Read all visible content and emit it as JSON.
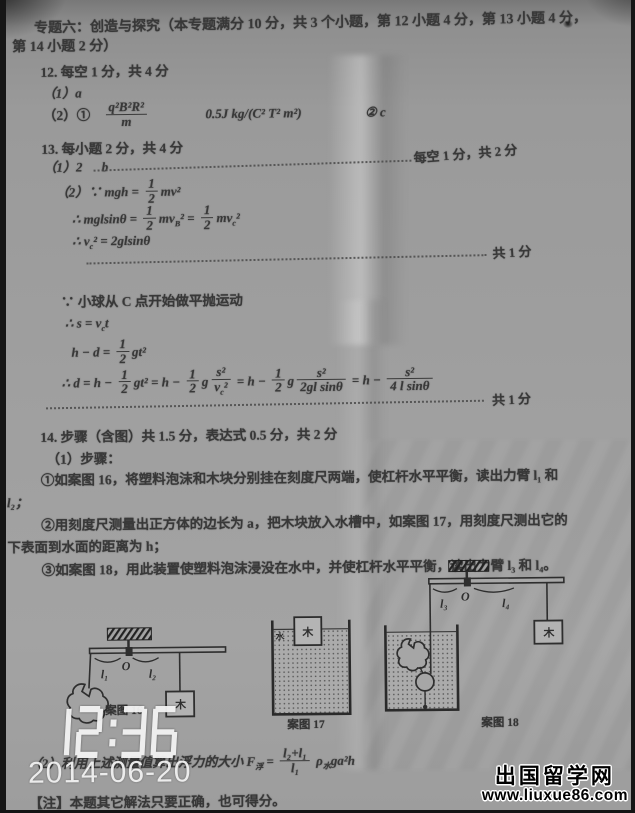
{
  "overlay": {
    "time": "12:36",
    "date": "2014-06-20"
  },
  "watermark": {
    "site_name": "出国留学网",
    "url_prefix": "www.liuxue",
    "url_num": "86",
    "url_suffix": ".com",
    "red": "#c3261c",
    "blue": "#1e3e9e"
  },
  "header": {
    "line1": "专题六：创造与探究（本专题满分 10 分，共 3 个小题，第 12 小题 4 分，第 13 小题 4 分，",
    "line2": "第 14 小题 2 分）"
  },
  "q12": {
    "title": "12. 每空 1 分，共 4 分",
    "part1": "（1）a",
    "part2_label": "（2）①",
    "frac": {
      "num": "q²B²R²",
      "den": "m"
    },
    "unit": "0.5J kg/(C² T² m²)",
    "part2b": "② c"
  },
  "q13": {
    "title": "13. 每小题 2 分，共 4 分",
    "part1": "（1）2",
    "part1_b": "b",
    "part1_score": "每空 1 分，共 2 分",
    "eq1": "（2）∵ mgh = {1|2}mv²",
    "eq2": "∴ mglsinθ = {1|2}mv~B~² = {1|2}mv~c~²",
    "eq3": "∴ v~c~² = 2glsinθ",
    "score1": "共 1 分",
    "line4": "∵ 小球从 C 点开始做平抛运动",
    "eq5": "∴ s = v~c~t",
    "eq6": "h − d = {1|2}gt²",
    "eq7": "∴ d = h − {1|2}gt² = h − {1|2}g{s²|v~c~²} = h − {1|2}g{s²|2gl sinθ} = h − {s²|4 l sinθ}",
    "score2": "共 1 分"
  },
  "q14": {
    "title": "14. 步骤（含图）共 1.5 分，表达式 0.5 分，共 2 分",
    "sub1": "（1）步骤：",
    "step1": "①如案图 16，将塑料泡沫和木块分别挂在刻度尺两端，使杠杆水平平衡，读出力臂 l₁ 和",
    "step1b": "l₂；",
    "step2": "②用刻度尺测量出正方体的边长为 a，把木块放入水槽中，如案图 17，用刻度尺测出它的",
    "step2b": "下表面到水面的距离为 h；",
    "step3": "③如案图 18，用此装置使塑料泡沫浸没在水中，并使杠杆水平平衡，读出力臂 l₃ 和 l₄。",
    "part2_eq": "（2）利用上述测量值算出浮力的大小 F~浮~ = {l₂+l₁|l₁} ρ~水~ga²h",
    "note": "【注】本题其它解法只要正确，也可得分。"
  },
  "figures": {
    "fig16": {
      "caption": "案图 16",
      "l1": "l₁",
      "O": "O",
      "l2": "l₂",
      "wood": "木"
    },
    "fig17": {
      "caption": "案图 17",
      "water": "水",
      "wood": "木"
    },
    "fig18": {
      "caption": "案图 18",
      "l3": "l₃",
      "O": "O",
      "l4": "l₄",
      "wood": "木"
    }
  }
}
